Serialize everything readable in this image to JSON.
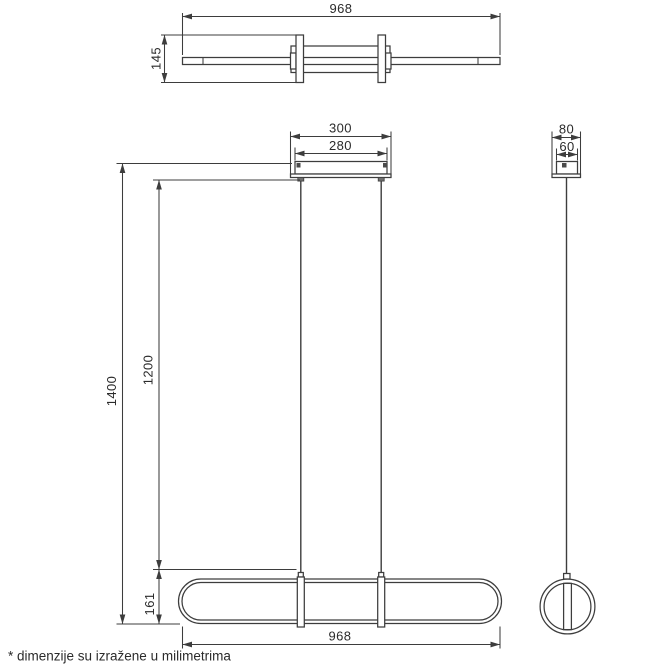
{
  "drawing": {
    "type": "technical-dimension-drawing",
    "subject": "linear-pendant-lamp",
    "unit": "mm"
  },
  "top_view": {
    "width_mm": "968",
    "depth_mm": "145"
  },
  "front_view": {
    "canopy_width_mm": "300",
    "canopy_body_width_mm": "280",
    "total_height_mm": "1400",
    "suspension_length_mm": "1200",
    "body_height_mm": "161",
    "body_width_mm": "968"
  },
  "side_view": {
    "canopy_depth_mm": "80",
    "canopy_body_depth_mm": "60"
  },
  "footer": {
    "note": "* dimenzije su izražene u milimetrima"
  },
  "colors": {
    "background": "#ffffff",
    "line": "#3d3d3d",
    "text": "#2b2b2b"
  }
}
